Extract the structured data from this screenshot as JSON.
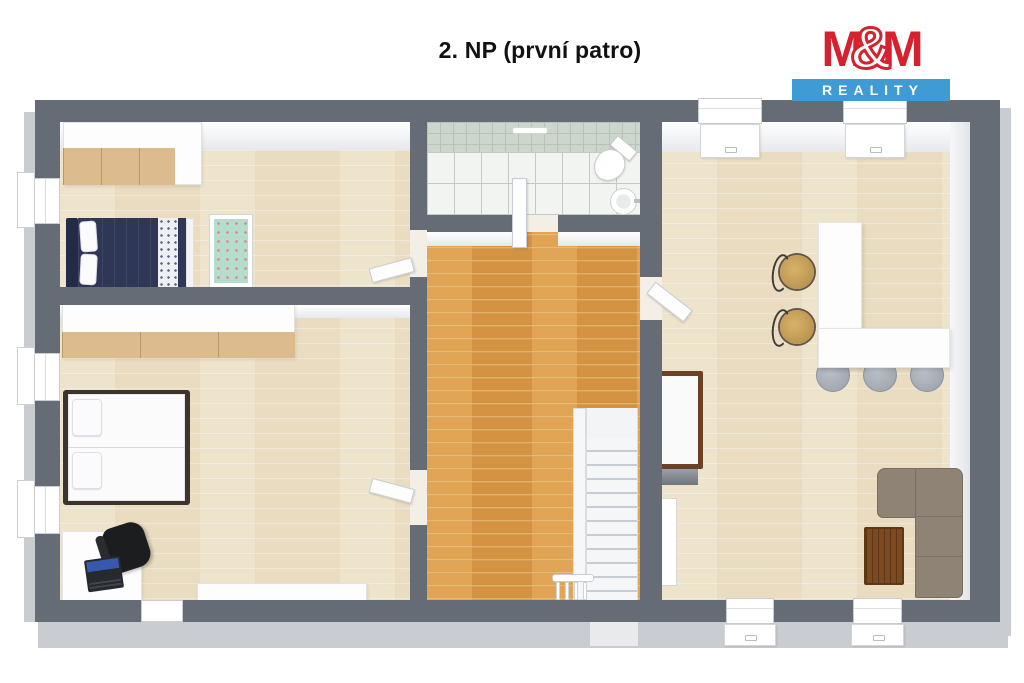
{
  "title": {
    "text": "2. NP (první patro)"
  },
  "logo": {
    "m1": "M",
    "amp": "&",
    "m2": "M",
    "bottom": "REALITY",
    "colors": {
      "red": "#d6222f",
      "blue": "#3e9bd3",
      "white": "#ffffff"
    }
  },
  "palette": {
    "wall": "#656c75",
    "wall_outer_band": "#c9cdd2",
    "floor_light_wood": "#e9dcc0",
    "floor_oak_hall": "#d49343",
    "bathroom_tile_floor": "#f1f4f1",
    "bathroom_tile_wall": "#ccd6cc",
    "sofa_taupe": "#8e8375",
    "table_wood": "#7b4a21",
    "bed_navy": "#2f3757",
    "wardrobe_wood": "#dcbc8e",
    "crib_mint": "#b5ddcb",
    "stool_gray": "#a7adb5",
    "chair_rattan": "#c9a258"
  },
  "furniture": {
    "bedroom_top": [
      "wardrobe",
      "double-bed-navy",
      "crib"
    ],
    "bedroom_bottom": [
      "wardrobe-row",
      "double-bed-white",
      "desk",
      "office-chair",
      "laptop",
      "low-cabinet"
    ],
    "bathroom": [
      "toilet",
      "sink",
      "towel-rail"
    ],
    "hall": [
      "staircase",
      "stair-railing"
    ],
    "living_room": [
      "kitchen-counter-L",
      "bar-stools",
      "dining-chairs",
      "single-bed",
      "leaning-panel",
      "corner-sofa",
      "coffee-table"
    ]
  }
}
